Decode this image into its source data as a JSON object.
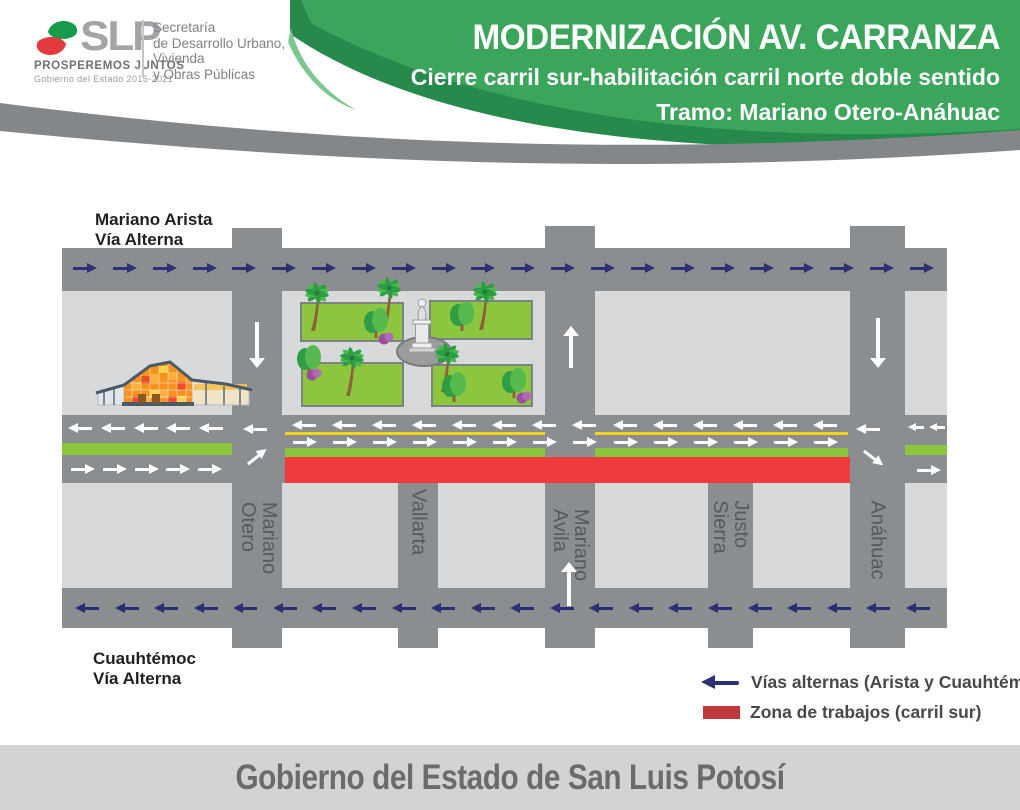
{
  "header": {
    "logo": {
      "acronym": "SLP",
      "motto": "PROSPEREMOS JUNTOS",
      "government": "Gobierno del Estado 2015-2021",
      "secretariat_lines": [
        "Secretaría",
        "de Desarrollo Urbano,",
        "Vivienda",
        "y Obras Públicas"
      ]
    },
    "title": "MODERNIZACIÓN AV. CARRANZA",
    "subtitle": "Cierre carril sur-habilitación carril norte doble sentido",
    "stretch": "Tramo: Mariano Otero-Anáhuac"
  },
  "map": {
    "north_alternate": {
      "name": "Mariano Arista",
      "type": "Vía Alterna",
      "flow": "eastbound"
    },
    "south_alternate": {
      "name": "Cuauhtémoc",
      "type": "Vía Alterna",
      "flow": "westbound"
    },
    "main_avenue": {
      "name": "Av. Carranza",
      "north_lane": "doble sentido (abierto)",
      "south_lane": "cerrado - zona de trabajos",
      "work_zone_from": "Mariano Otero",
      "work_zone_to": "Anáhuac"
    },
    "cross_streets": [
      {
        "name": "Mariano Otero",
        "lines": [
          "Mariano",
          "Otero"
        ],
        "flow": "southbound"
      },
      {
        "name": "Vallarta",
        "lines": [
          "Vallarta"
        ],
        "flow": ""
      },
      {
        "name": "Mariano Avila",
        "lines": [
          "Mariano",
          "Avila"
        ],
        "flow": "northbound"
      },
      {
        "name": "Justo Sierra",
        "lines": [
          "Justo",
          "Sierra"
        ],
        "flow": ""
      },
      {
        "name": "Anáhuac",
        "lines": [
          "Anáhuac"
        ],
        "flow": "southbound"
      }
    ]
  },
  "legend": {
    "items": [
      {
        "symbol": "navy-left-arrow",
        "label": "Vías alternas (Arista y Cuauhtémoc)"
      },
      {
        "symbol": "red-bar",
        "label": "Zona de trabajos (carril sur)"
      }
    ]
  },
  "footer": {
    "text": "Gobierno del Estado de San Luis Potosí"
  },
  "palette": {
    "header_green": "#3BA55C",
    "header_dark_green": "#27894B",
    "band_gray": "#84878A",
    "road_gray": "#8A8E90",
    "block_gray": "#D8D9DA",
    "alt_route_navy": "#2D2F73",
    "lane_arrow_white": "#FFFFFF",
    "median_green": "#8CC63F",
    "center_line_yellow": "#F2D41E",
    "work_zone_red": "#EF3B3C",
    "legend_red": "#BE393B",
    "footer_gray": "#D2D3D4"
  }
}
